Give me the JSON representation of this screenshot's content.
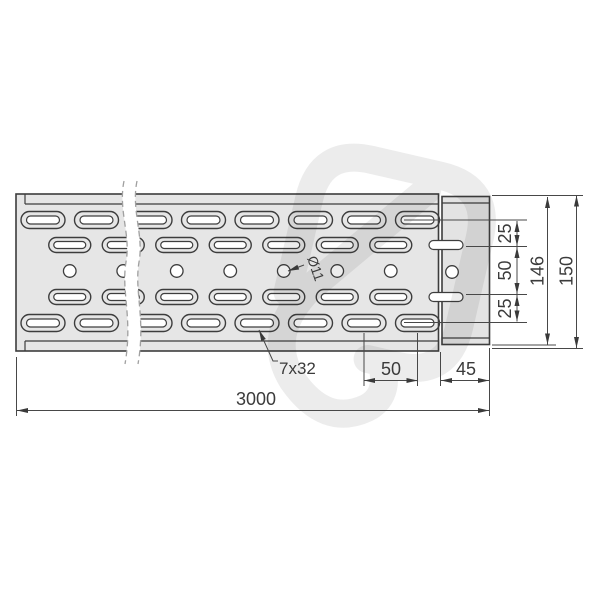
{
  "drawing": {
    "dims": {
      "overall_length": "3000",
      "slot_pitch_bottom": "50",
      "end_overhang": "45",
      "right_chain_top": "25",
      "right_chain_mid": "50",
      "right_chain_bottom": "25",
      "connector_height": "146",
      "tray_width": "150"
    },
    "labels": {
      "slot_size": "7x32",
      "hole_diameter": "Ø11"
    },
    "colors": {
      "background": "#ffffff",
      "part_fill": "#e6e6e6",
      "end_fill": "#e3e3e3",
      "outline": "#3d3d3d",
      "dimension_line": "#484848",
      "text": "#3b3b3b",
      "break_line": "#a0a0a0",
      "watermark": "#1a1a1a"
    }
  }
}
